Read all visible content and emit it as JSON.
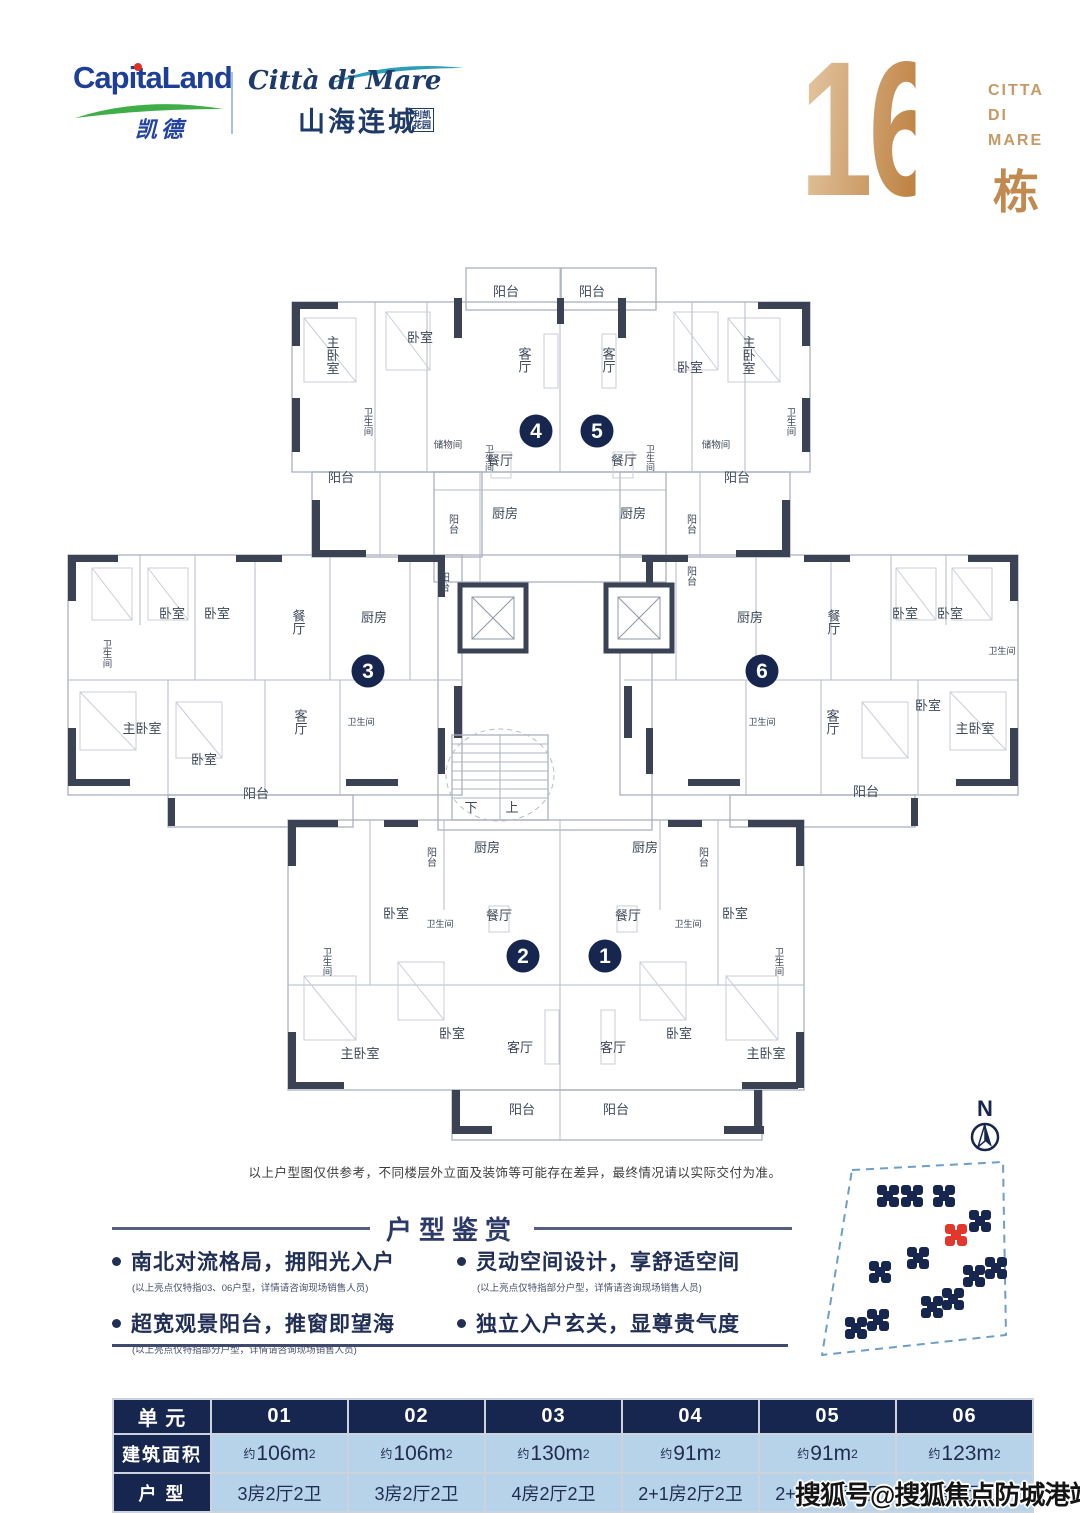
{
  "header": {
    "capitaland": {
      "name": "CapitaLand",
      "cn": "凯德"
    },
    "citta_logo": {
      "script": "Città di Mare",
      "cn": "山海连城",
      "seal_line1": "利凯",
      "seal_line2": "花园"
    },
    "building": {
      "number": "16",
      "label": "栋",
      "citta_lines": [
        "CITTA",
        "DI",
        "MARE"
      ]
    }
  },
  "floor_plan": {
    "unit_circles": [
      {
        "n": "1",
        "x": 605,
        "y": 706
      },
      {
        "n": "2",
        "x": 523,
        "y": 706
      },
      {
        "n": "3",
        "x": 368,
        "y": 421
      },
      {
        "n": "4",
        "x": 536,
        "y": 181
      },
      {
        "n": "5",
        "x": 597,
        "y": 181
      },
      {
        "n": "6",
        "x": 762,
        "y": 421
      }
    ],
    "core": {
      "down": "下",
      "up": "上"
    },
    "labels": [
      {
        "t": "阳台",
        "x": 506,
        "y": 46
      },
      {
        "t": "阳台",
        "x": 592,
        "y": 46
      },
      {
        "t": "主卧室",
        "x": 332,
        "y": 105,
        "v": 1
      },
      {
        "t": "卧室",
        "x": 420,
        "y": 92
      },
      {
        "t": "客厅",
        "x": 524,
        "y": 110,
        "v": 1
      },
      {
        "t": "客厅",
        "x": 608,
        "y": 110,
        "v": 1
      },
      {
        "t": "卧室",
        "x": 690,
        "y": 122
      },
      {
        "t": "主卧室",
        "x": 748,
        "y": 105,
        "v": 1
      },
      {
        "t": "卫生间",
        "x": 367,
        "y": 172,
        "v": 1,
        "s": 9.5
      },
      {
        "t": "卫生间",
        "x": 790,
        "y": 172,
        "v": 1,
        "s": 9.5
      },
      {
        "t": "储物间",
        "x": 448,
        "y": 198,
        "s": 9.5
      },
      {
        "t": "储物间",
        "x": 716,
        "y": 198,
        "s": 9.5
      },
      {
        "t": "卫生间",
        "x": 489,
        "y": 208,
        "v": 1,
        "s": 9
      },
      {
        "t": "卫生间",
        "x": 650,
        "y": 208,
        "v": 1,
        "s": 9
      },
      {
        "t": "餐厅",
        "x": 500,
        "y": 215
      },
      {
        "t": "餐厅",
        "x": 624,
        "y": 215
      },
      {
        "t": "阳台",
        "x": 341,
        "y": 232
      },
      {
        "t": "阳台",
        "x": 737,
        "y": 232
      },
      {
        "t": "阳台",
        "x": 452,
        "y": 274,
        "v": 1,
        "s": 10
      },
      {
        "t": "厨房",
        "x": 505,
        "y": 268
      },
      {
        "t": "厨房",
        "x": 633,
        "y": 268
      },
      {
        "t": "阳台",
        "x": 690,
        "y": 274,
        "v": 1,
        "s": 10
      },
      {
        "t": "阳台",
        "x": 443,
        "y": 332,
        "v": 1,
        "s": 10
      },
      {
        "t": "阳台",
        "x": 690,
        "y": 326,
        "v": 1,
        "s": 10
      },
      {
        "t": "卧室",
        "x": 172,
        "y": 368
      },
      {
        "t": "卧室",
        "x": 217,
        "y": 368
      },
      {
        "t": "餐厅",
        "x": 298,
        "y": 372,
        "v": 1
      },
      {
        "t": "厨房",
        "x": 374,
        "y": 372
      },
      {
        "t": "厨房",
        "x": 750,
        "y": 372
      },
      {
        "t": "餐厅",
        "x": 833,
        "y": 372,
        "v": 1
      },
      {
        "t": "卧室",
        "x": 905,
        "y": 368
      },
      {
        "t": "卧室",
        "x": 950,
        "y": 368
      },
      {
        "t": "卫生间",
        "x": 106,
        "y": 404,
        "v": 1,
        "s": 9.5
      },
      {
        "t": "卫生间",
        "x": 1002,
        "y": 404,
        "s": 9
      },
      {
        "t": "主卧室",
        "x": 142,
        "y": 483
      },
      {
        "t": "卧室",
        "x": 204,
        "y": 514
      },
      {
        "t": "客厅",
        "x": 300,
        "y": 472,
        "v": 1
      },
      {
        "t": "卫生间",
        "x": 361,
        "y": 475,
        "s": 9
      },
      {
        "t": "卫生间",
        "x": 762,
        "y": 475,
        "s": 9
      },
      {
        "t": "客厅",
        "x": 832,
        "y": 472,
        "v": 1
      },
      {
        "t": "卧室",
        "x": 928,
        "y": 460
      },
      {
        "t": "主卧室",
        "x": 975,
        "y": 483
      },
      {
        "t": "阳台",
        "x": 256,
        "y": 548
      },
      {
        "t": "阳台",
        "x": 866,
        "y": 546
      },
      {
        "t": "阳台",
        "x": 430,
        "y": 607,
        "v": 1,
        "s": 10
      },
      {
        "t": "厨房",
        "x": 487,
        "y": 602
      },
      {
        "t": "厨房",
        "x": 645,
        "y": 602
      },
      {
        "t": "阳台",
        "x": 702,
        "y": 607,
        "v": 1,
        "s": 10
      },
      {
        "t": "卧室",
        "x": 396,
        "y": 668
      },
      {
        "t": "卫生间",
        "x": 440,
        "y": 677,
        "s": 9
      },
      {
        "t": "餐厅",
        "x": 499,
        "y": 670
      },
      {
        "t": "餐厅",
        "x": 628,
        "y": 670
      },
      {
        "t": "卫生间",
        "x": 688,
        "y": 677,
        "s": 9
      },
      {
        "t": "卧室",
        "x": 735,
        "y": 668
      },
      {
        "t": "卫生间",
        "x": 326,
        "y": 712,
        "v": 1,
        "s": 9.5
      },
      {
        "t": "卫生间",
        "x": 778,
        "y": 712,
        "v": 1,
        "s": 9.5
      },
      {
        "t": "主卧室",
        "x": 360,
        "y": 808
      },
      {
        "t": "卧室",
        "x": 452,
        "y": 788
      },
      {
        "t": "客厅",
        "x": 520,
        "y": 802
      },
      {
        "t": "客厅",
        "x": 613,
        "y": 802
      },
      {
        "t": "卧室",
        "x": 679,
        "y": 788
      },
      {
        "t": "主卧室",
        "x": 766,
        "y": 808
      },
      {
        "t": "阳台",
        "x": 522,
        "y": 864
      },
      {
        "t": "阳台",
        "x": 616,
        "y": 864
      }
    ]
  },
  "site_map": {
    "compass": "N",
    "buildings": [
      {
        "x": 98,
        "y": 116
      },
      {
        "x": 122,
        "y": 116
      },
      {
        "x": 154,
        "y": 116
      },
      {
        "x": 166,
        "y": 155,
        "highlight": true
      },
      {
        "x": 190,
        "y": 141
      },
      {
        "x": 128,
        "y": 178
      },
      {
        "x": 90,
        "y": 192
      },
      {
        "x": 184,
        "y": 196
      },
      {
        "x": 206,
        "y": 188
      },
      {
        "x": 142,
        "y": 227
      },
      {
        "x": 163,
        "y": 219
      },
      {
        "x": 66,
        "y": 248
      },
      {
        "x": 88,
        "y": 240
      }
    ]
  },
  "disclaimer": "以上户型图仅供参考，不同楼层外立面及装饰等可能存在差异，最终情况请以实际交付为准。",
  "section": {
    "title": "户型鉴赏",
    "features": [
      {
        "text": "南北对流格局，拥阳光入户",
        "note": "(以上亮点仅特指03、06户型，详情请咨询现场销售人员)"
      },
      {
        "text": "超宽观景阳台，推窗即望海",
        "note": "(以上亮点仅特指部分户型，详情请咨询现场销售人员)"
      },
      {
        "text": "灵动空间设计，享舒适空间",
        "note": "(以上亮点仅特指部分户型，详情请咨询现场销售人员)"
      },
      {
        "text": "独立入户玄关，显尊贵气度",
        "note": ""
      }
    ]
  },
  "table": {
    "row_labels": [
      "单 元",
      "建筑面积",
      "户 型"
    ],
    "units": [
      "01",
      "02",
      "03",
      "04",
      "05",
      "06"
    ],
    "areas": [
      {
        "approx": "约",
        "value": "106m",
        "sup": "2"
      },
      {
        "approx": "约",
        "value": "106m",
        "sup": "2"
      },
      {
        "approx": "约",
        "value": "130m",
        "sup": "2"
      },
      {
        "approx": "约",
        "value": "91m",
        "sup": "2"
      },
      {
        "approx": "约",
        "value": "91m",
        "sup": "2"
      },
      {
        "approx": "约",
        "value": "123m",
        "sup": "2"
      }
    ],
    "types": [
      "3房2厅2卫",
      "3房2厅2卫",
      "4房2厅2卫",
      "2+1房2厅2卫",
      "2+1房2厅2卫",
      "4房2厅2卫"
    ]
  },
  "watermark": "搜狐号@搜狐焦点防城港站",
  "colors": {
    "navy": "#16264e",
    "cell_blue": "#b7d3ea",
    "gold": "#c89355",
    "red_building": "#e2372b",
    "map_outline": "#6d9ec7",
    "capitaland_blue": "#1d3f97",
    "logo_green": "#3fae49",
    "logo_teal": "#2a9fb5"
  }
}
